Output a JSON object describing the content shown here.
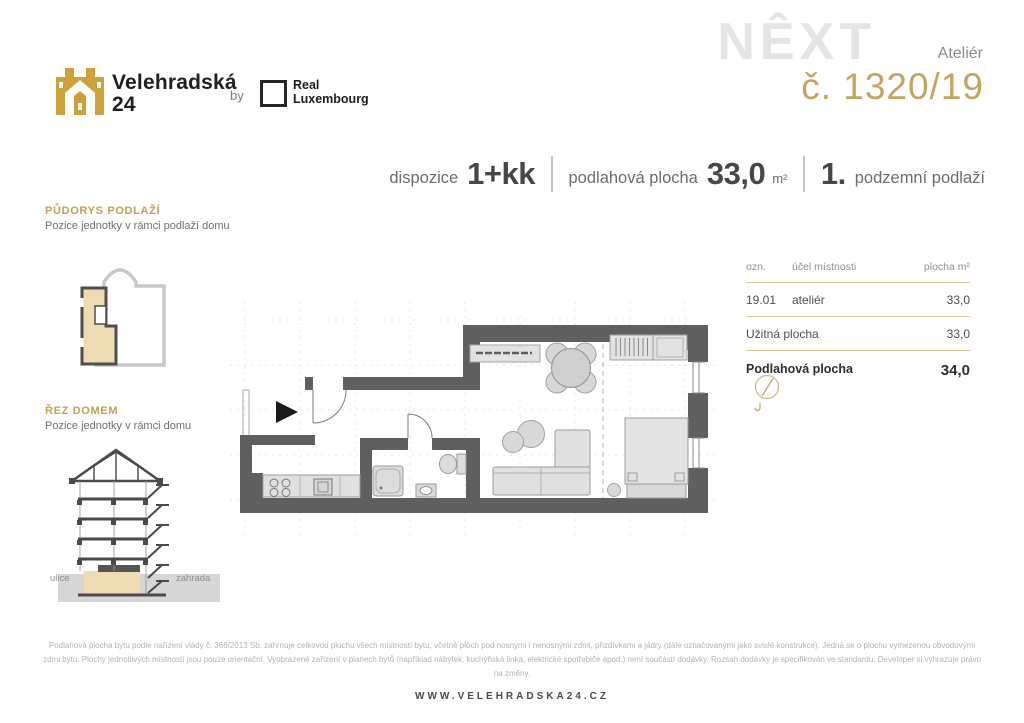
{
  "branding": {
    "name_line1": "Velehradská",
    "name_line2": "24",
    "by": "by",
    "partner_line1": "Real",
    "partner_line2": "Luxembourg"
  },
  "watermark": "NÊXT",
  "unit": {
    "type": "Ateliér",
    "number": "č. 1320/19"
  },
  "summary": {
    "layout_label": "dispozice",
    "layout_value": "1+kk",
    "area_label": "podlahová plocha",
    "area_value": "33,0",
    "area_unit": "m²",
    "floor_value": "1.",
    "floor_label": "podzemní podlaží"
  },
  "sidebar": {
    "floorplan_title": "PŮDORYS PODLAŽÍ",
    "floorplan_subtitle": "Pozice jednotky v rámci podlaží domu",
    "section_title": "ŘEZ DOMEM",
    "section_subtitle": "Pozice jednotky v rámci domu",
    "street_label": "ulice",
    "garden_label": "zahrada"
  },
  "rooms_table": {
    "col_ozn": "ozn.",
    "col_purpose": "účel místnosti",
    "col_area": "plocha m²",
    "rows": [
      {
        "ozn": "19.01",
        "purpose": "ateliér",
        "area": "33,0"
      }
    ],
    "usable_label": "Užitná plocha",
    "usable_area": "33,0",
    "total_label": "Podlahová plocha",
    "total_area": "34,0"
  },
  "footer": {
    "disclaimer": "Podlahová plocha bytu podle nařízení vlády č. 366/2013 Sb. zahrnuje celkovou plochu všech místností bytu, včetně ploch pod nosnými i nenosnými zdmi, přizdívkami a jádry (dále označovanými jako svislé konstrukce). Jedná se o plochu vymezenou obvodovými zdmi bytu. Plochy jednotlivých místností jsou pouze orientační. Vyobrazené zařízení v planech bytů (například nábytek, kuchyňská linka, elektrické spotřebiče apod.) není součástí dodávky. Rozsah dodávky je specifikován ve standardu. Developer si vyhrazuje právo na změny.",
    "website": "WWW.VELEHRADSKA24.CZ"
  },
  "colors": {
    "accent_gold": "#c8a35f",
    "label_gold": "#c3a154",
    "wall_gray": "#5f5f5f",
    "unit_beige": "#eedcb4",
    "table_line": "#d9c69a",
    "watermark_gray": "#e4e4e4"
  }
}
